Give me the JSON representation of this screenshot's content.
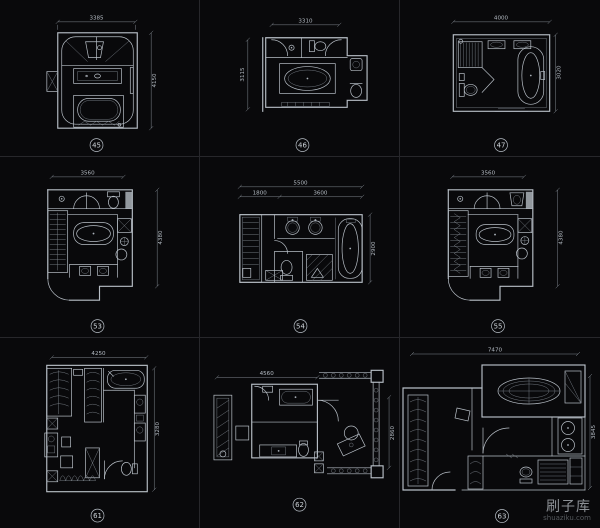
{
  "page": {
    "background": "#09090b",
    "grid_line_color": "#27272b",
    "drawing_line_color": "#b9c0c8",
    "dim_text_color": "#b4bbc3"
  },
  "watermark": {
    "title": "刷子库",
    "subtitle": "shuaziku.com"
  },
  "plans": [
    {
      "id": "45",
      "dim_top": "3385",
      "dim_side": "4150"
    },
    {
      "id": "46",
      "dim_top": "3310",
      "dim_side": "3115"
    },
    {
      "id": "47",
      "dim_top": "4000",
      "dim_side": "3020"
    },
    {
      "id": "53",
      "dim_top": "3560",
      "dim_side": "4380"
    },
    {
      "id": "54",
      "dim_top": "5500",
      "dim_top_sub1": "1800",
      "dim_top_sub2": "3600",
      "dim_side": "2900"
    },
    {
      "id": "55",
      "dim_top": "3560",
      "dim_side": "4380"
    },
    {
      "id": "61",
      "dim_top": "4250",
      "dim_side": "3280"
    },
    {
      "id": "62",
      "dim_top": "4560",
      "dim_side": "2860"
    },
    {
      "id": "63",
      "dim_top": "7470",
      "dim_side": "3845"
    }
  ]
}
